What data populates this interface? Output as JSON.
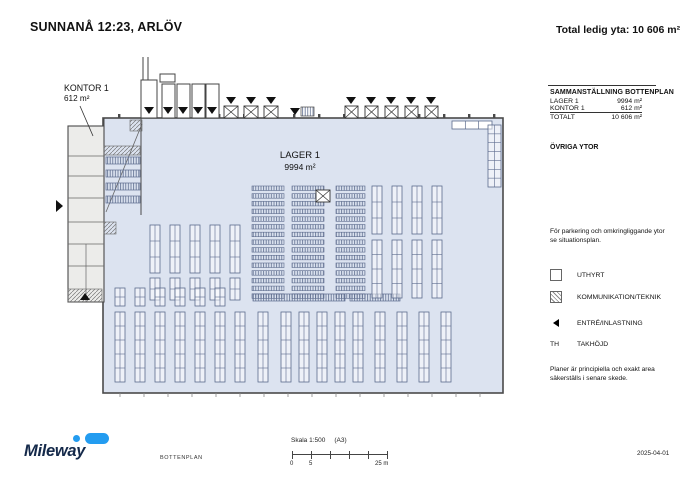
{
  "header": {
    "title": "SUNNANÅ 12:23, ARLÖV",
    "total": "Total ledig yta: 10 606 m²"
  },
  "plan_labels": {
    "lager_name": "LAGER 1",
    "lager_area": "9994 m²",
    "kontor_name": "KONTOR 1",
    "kontor_area": "612 m²"
  },
  "panel": {
    "summary_title": "SAMMANSTÄLLNING BOTTENPLAN",
    "rows": [
      {
        "label": "LAGER 1",
        "value": "9994 m²"
      },
      {
        "label": "KONTOR 1",
        "value": "612 m²"
      }
    ],
    "total": {
      "label": "TOTALT",
      "value": "10 606 m²"
    },
    "other_title": "ÖVRIGA YTOR",
    "parking_note": "För parkering och omkringliggande ytor se situationsplan.",
    "legend": [
      {
        "label": "UTHYRT"
      },
      {
        "label": "KOMMUNIKATION/TEKNIK"
      },
      {
        "label": "ENTRÉ/INLASTNING"
      },
      {
        "label": "TAKHÖJD",
        "abbr": "TH"
      }
    ],
    "disclaimer": "Planer är principiella och exakt area säkerställs i senare skede."
  },
  "footer": {
    "brand": "Mileway",
    "drawing_type": "BOTTENPLAN",
    "scale": "Skala 1:500",
    "paper_size": "(A3)",
    "ruler_labels": [
      "0",
      "5",
      "25 m"
    ],
    "date": "2025-04-01"
  },
  "colors": {
    "plan_fill": "#dce3f0",
    "office_fill": "#ececea",
    "wall": "#4a4a4a",
    "rack": "#5c6b8d",
    "brand_navy": "#14294a",
    "brand_blue": "#239cf0"
  },
  "floorplan": {
    "warehouse": [
      103,
      118,
      400,
      275
    ],
    "office": [
      68,
      126,
      36,
      176
    ],
    "office_lines": [
      [
        68,
        156,
        104,
        156
      ],
      [
        68,
        176,
        104,
        176
      ],
      [
        68,
        198,
        104,
        198
      ],
      [
        68,
        222,
        104,
        222
      ],
      [
        68,
        244,
        104,
        244
      ],
      [
        68,
        266,
        104,
        266
      ],
      [
        86,
        244,
        86,
        302
      ]
    ],
    "extra_lines": [
      [
        141,
        118,
        141,
        215
      ],
      [
        104,
        118,
        104,
        126
      ]
    ],
    "label_line": [
      80,
      106,
      93,
      136
    ],
    "hatch_rects": [
      [
        104,
        146,
        36,
        9
      ],
      [
        104,
        222,
        12,
        12
      ],
      [
        68,
        289,
        34,
        13
      ],
      [
        130,
        120,
        12,
        11
      ]
    ],
    "diagonal_lines": [
      [
        106,
        212,
        142,
        124
      ]
    ],
    "strip_bars": [
      [
        106,
        157,
        34,
        7
      ],
      [
        106,
        170,
        34,
        7
      ],
      [
        106,
        183,
        34,
        7
      ],
      [
        106,
        196,
        34,
        7
      ]
    ],
    "canopy_lines": [
      [
        143,
        57,
        143,
        80
      ],
      [
        148,
        57,
        148,
        80
      ]
    ],
    "dock_rects": [
      [
        141,
        80,
        16,
        38
      ],
      [
        162,
        84,
        13,
        34
      ],
      [
        177,
        84,
        13,
        34
      ],
      [
        192,
        84,
        13,
        34
      ],
      [
        206,
        84,
        13,
        34
      ]
    ],
    "dock_cap": [
      160,
      74,
      15,
      8
    ],
    "down_triangles": [
      [
        149,
        114
      ],
      [
        168,
        114
      ],
      [
        183,
        114
      ],
      [
        198,
        114
      ],
      [
        212,
        114
      ],
      [
        231,
        104
      ],
      [
        251,
        104
      ],
      [
        271,
        104
      ],
      [
        295,
        115
      ],
      [
        351,
        104
      ],
      [
        371,
        104
      ],
      [
        391,
        104
      ],
      [
        411,
        104
      ],
      [
        431,
        104
      ]
    ],
    "xboxes": [
      [
        224,
        106,
        14,
        12
      ],
      [
        244,
        106,
        14,
        12
      ],
      [
        264,
        106,
        14,
        12
      ],
      [
        345,
        106,
        13,
        12
      ],
      [
        365,
        106,
        13,
        12
      ],
      [
        385,
        106,
        13,
        12
      ],
      [
        405,
        106,
        13,
        12
      ],
      [
        425,
        106,
        13,
        12
      ]
    ],
    "grid_block": [
      301,
      107,
      13,
      9
    ],
    "tr_hrack": [
      452,
      121,
      40,
      8
    ],
    "tr_ladder": [
      488,
      125,
      13,
      62
    ],
    "central_cols": [
      [
        252,
        32
      ],
      [
        292,
        32
      ],
      [
        336,
        29
      ]
    ],
    "central_rows": {
      "y0": 186,
      "n": 15,
      "h": 4.5,
      "step": 7.7
    },
    "block_xbox": [
      316,
      190,
      14,
      12
    ],
    "vrack_groups": [
      {
        "xs": [
          150,
          170,
          190,
          210,
          230
        ],
        "y": 225,
        "w": 10,
        "h": 48
      },
      {
        "xs": [
          150,
          170,
          190,
          210,
          230
        ],
        "y": 278,
        "w": 10,
        "h": 22
      },
      {
        "xs": [
          372,
          392,
          412,
          432
        ],
        "y": 186,
        "w": 10,
        "h": 48
      },
      {
        "xs": [
          372,
          392,
          412,
          432
        ],
        "y": 240,
        "w": 10,
        "h": 58
      },
      {
        "xs": [
          115,
          135,
          155,
          175,
          195,
          215
        ],
        "y": 288,
        "w": 10,
        "h": 18
      },
      {
        "xs": [
          115,
          135,
          155,
          175,
          195,
          215,
          235,
          258,
          281,
          299,
          317,
          335,
          353,
          375,
          397,
          419,
          441
        ],
        "y": 312,
        "w": 10,
        "h": 70
      }
    ],
    "bottom_hbars": [
      [
        253,
        294,
        92,
        7
      ],
      [
        350,
        294,
        50,
        7
      ]
    ],
    "wall_ticks": {
      "y": 114,
      "x0": 118,
      "x1": 496,
      "step": 25
    },
    "bottom_ticks": {
      "y": 393,
      "x0": 120,
      "x1": 480,
      "step": 24
    },
    "left_triangle": [
      63,
      206
    ],
    "up_triangle": [
      85,
      300
    ]
  }
}
